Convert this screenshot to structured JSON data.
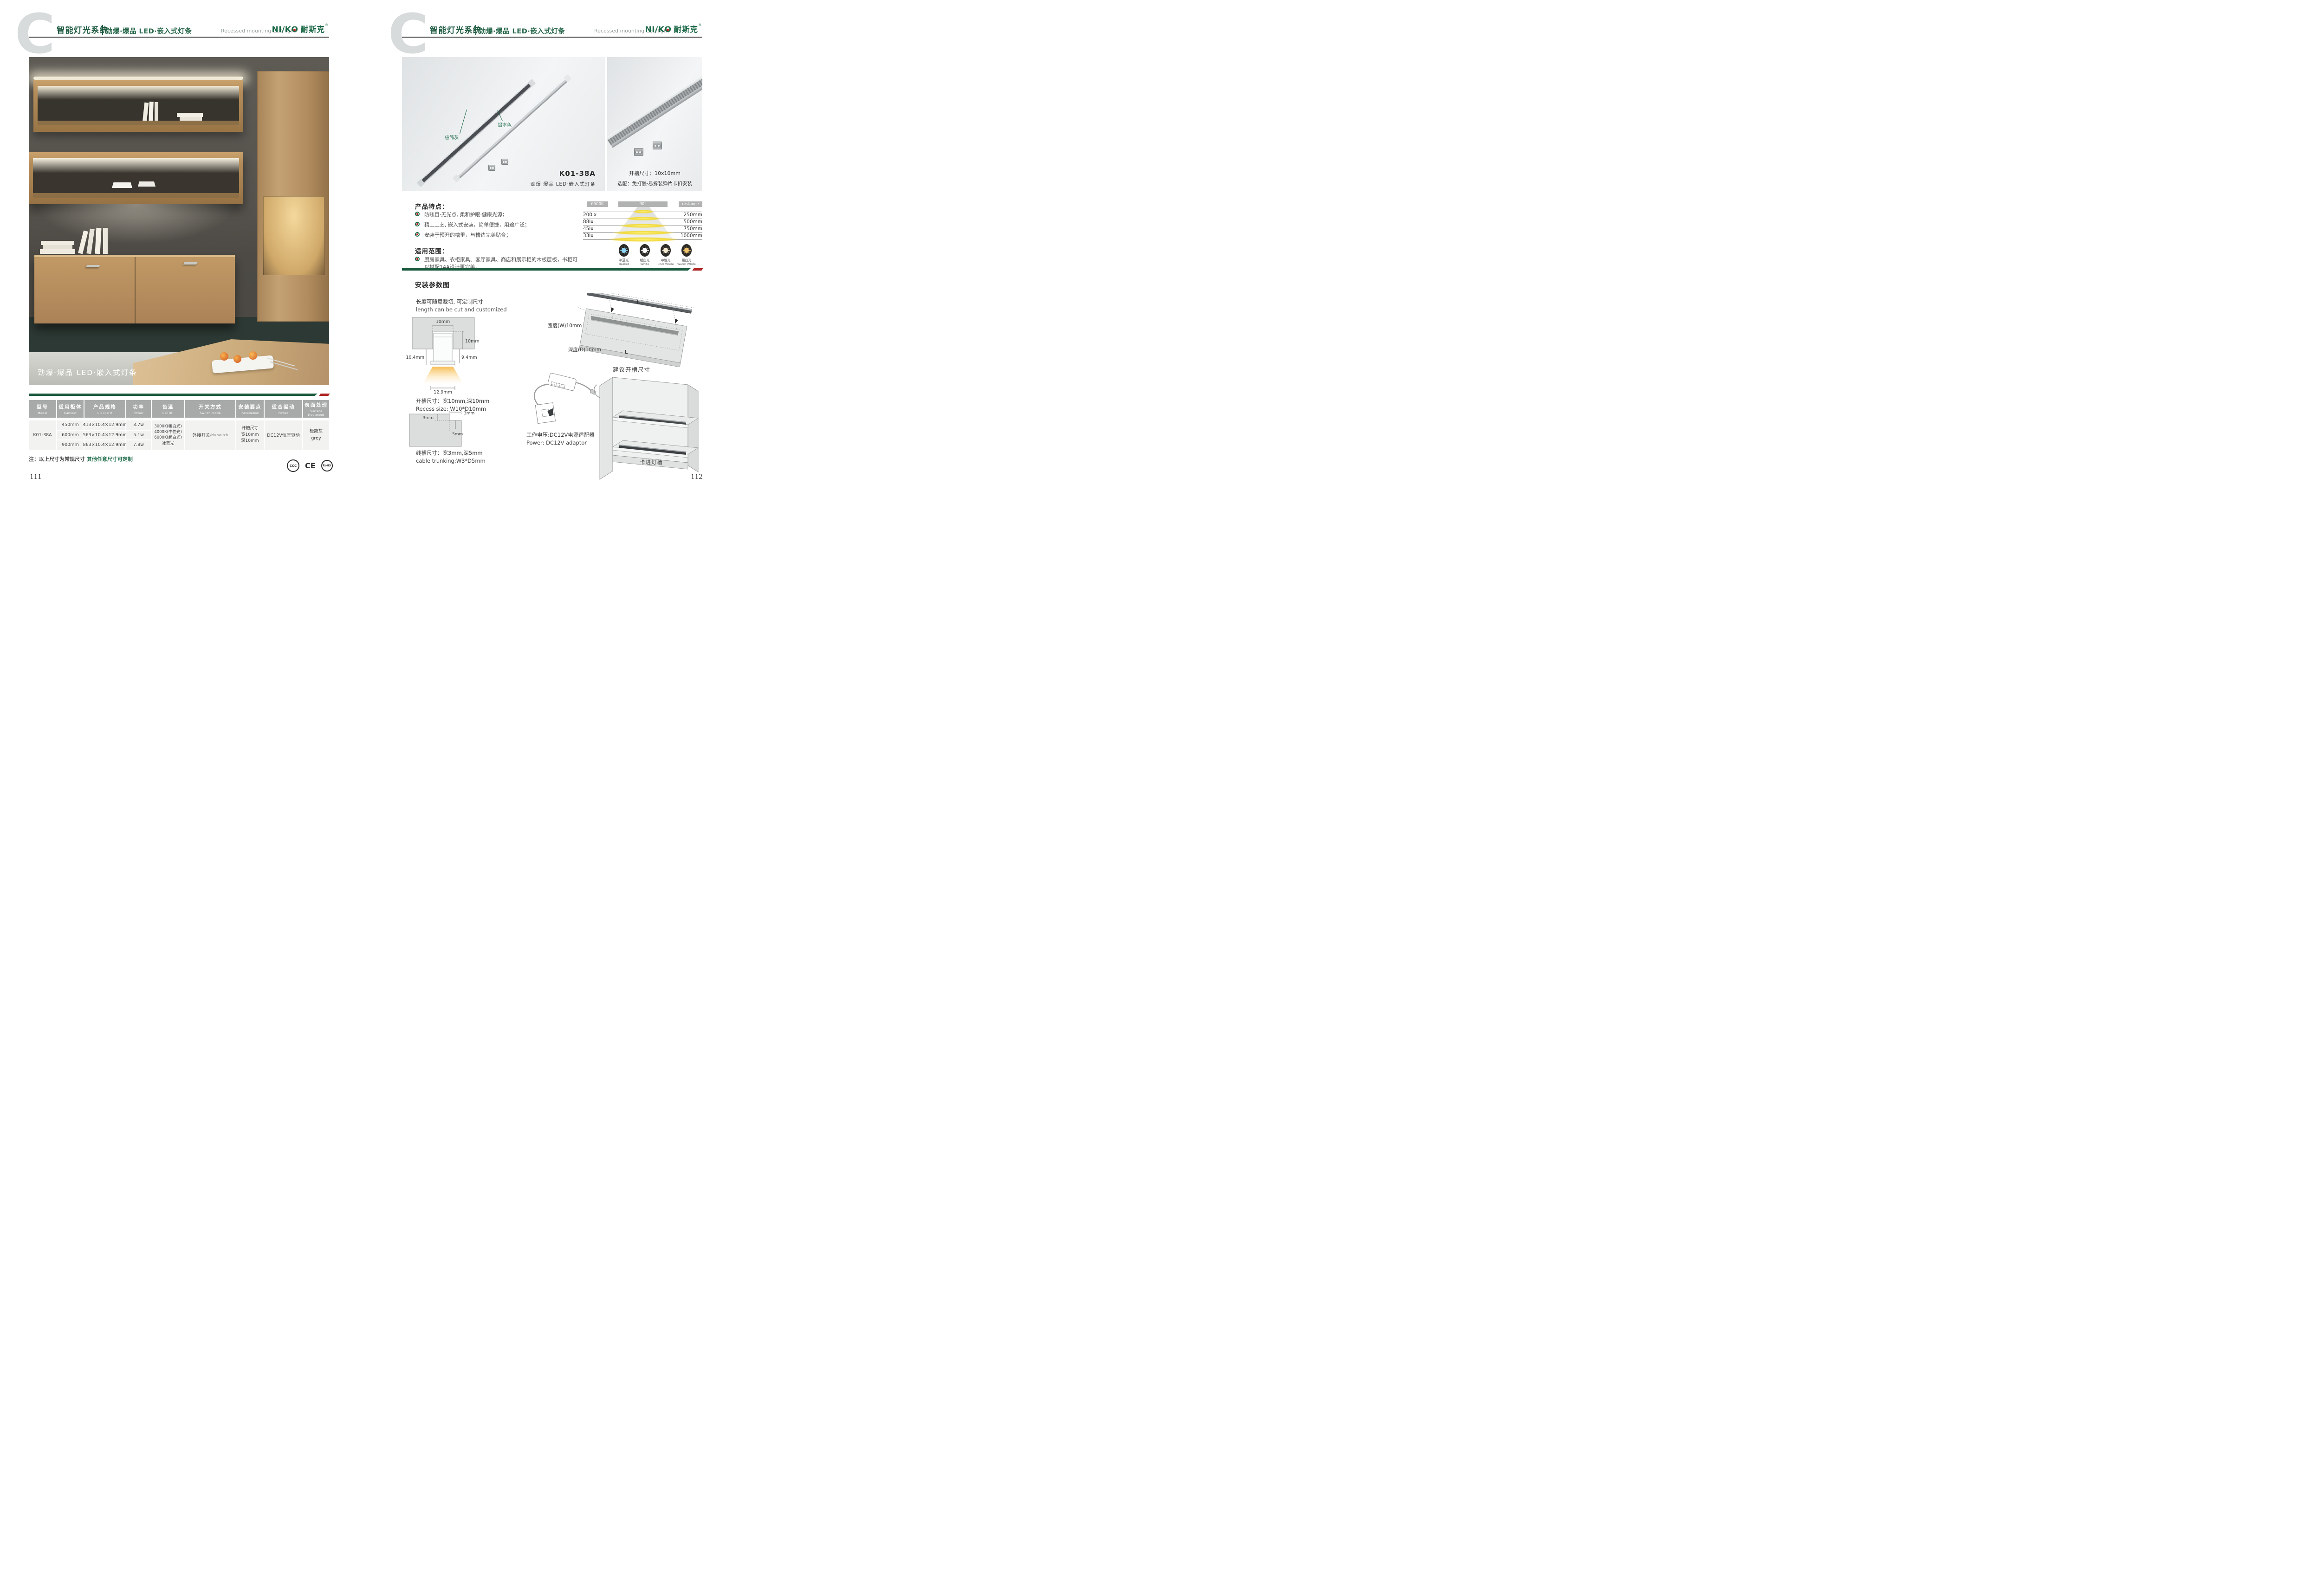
{
  "colors": {
    "brand_green": "#1f6b4a",
    "bar_green": "#1b5b40",
    "accent_red": "#ae2524",
    "header_gray": "#a7aaa9",
    "cell_gray": "#f2f2f1",
    "ice_blue": "#8fd4f5",
    "white": "#ffffff",
    "cool_white": "#f6ecd4",
    "warm_white": "#f2c56d"
  },
  "header": {
    "big_letter": "C",
    "title_cn": "智能灯光系统",
    "subtitle_cn": "劲爆·爆品  LED·嵌入式灯条",
    "subtitle_en": "Recessed mounting LED light",
    "logo": {
      "part1": "NI/K",
      "o": "O",
      "cn": "耐斯克",
      "reg": "®"
    }
  },
  "left_page": {
    "photo_caption": "劲爆·爆品  LED·嵌入式灯条",
    "table": {
      "headers": [
        {
          "cn": "型号",
          "en": "Model"
        },
        {
          "cn": "适用柜体",
          "en": "Cabinet"
        },
        {
          "cn": "产品规格",
          "en": "L x D x H"
        },
        {
          "cn": "功率",
          "en": "Power"
        },
        {
          "cn": "色温",
          "en": "CCT(K)"
        },
        {
          "cn": "开关方式",
          "en": "Switch mode"
        },
        {
          "cn": "安装要点",
          "en": "Installation"
        },
        {
          "cn": "适合驱动",
          "en": "Power"
        },
        {
          "cn": "表面处理",
          "en": "Surface treatment"
        }
      ],
      "model": "K01-38A",
      "rows": [
        {
          "cabinet": "450mm",
          "spec": "413×10.4×12.9mm",
          "power": "3.7w"
        },
        {
          "cabinet": "600mm",
          "spec": "563×10.4×12.9mm",
          "power": "5.1w"
        },
        {
          "cabinet": "900mm",
          "spec": "863×10.4×12.9mm",
          "power": "7.8w"
        }
      ],
      "cct_lines": [
        "3000K(暖白光)",
        "4000K(中性光)",
        "6000K(超白光)",
        "冰蓝光"
      ],
      "switch_main": "外接开关",
      "switch_sub": "/No switch",
      "install_lines": [
        "开槽尺寸",
        "宽10mm",
        "深10mm"
      ],
      "drive": "DC12V恒压驱动",
      "surface_lines": [
        "极简灰",
        "grey"
      ]
    },
    "note_prefix": "注：以上尺寸为常规尺寸 ",
    "note_highlight": "其他任意尺寸可定制",
    "certs": [
      {
        "label": "CCC"
      },
      {
        "label": "CE"
      },
      {
        "label": "RoHS"
      }
    ],
    "page_number": "111"
  },
  "right_page": {
    "photo_main": {
      "label_gray": "极简灰",
      "label_alu": "铝本色",
      "model": "K01-38A",
      "caption": "劲爆·爆品  LED·嵌入式灯条"
    },
    "photo_side": {
      "line1": "开槽尺寸：10x10mm",
      "line2": "选配：免打胶·易拆装弹片卡扣安装"
    },
    "features": {
      "title": "产品特点：",
      "items": [
        "防眩目·无光点, 柔和护眼·健康光源；",
        "精工工艺, 嵌入式安装，简单便捷，用途广泛；",
        "安装于预开的槽里，与槽边完美贴合；"
      ]
    },
    "scope": {
      "title": "适用范围：",
      "item": "厨房家具、衣柜家具、客厅家具、商店和展示柜的木板层板，书柜可以搭配14A设计更完美。"
    },
    "photometric": {
      "cct_chip": "6500K",
      "angle_chip": "90°",
      "distance_chip": "distance",
      "rows": [
        {
          "lux": "200lx",
          "distance": "250mm"
        },
        {
          "lux": "88lx",
          "distance": "500mm"
        },
        {
          "lux": "45lx",
          "distance": "750mm"
        },
        {
          "lux": "33lx",
          "distance": "1000mm"
        }
      ],
      "icons": [
        {
          "cn": "冰蓝光",
          "en": "Basket"
        },
        {
          "cn": "超白光",
          "en": "White"
        },
        {
          "cn": "中性光",
          "en": "Cool White"
        },
        {
          "cn": "暖白光",
          "en": "Warm White"
        }
      ]
    },
    "install": {
      "title": "安装参数图",
      "cut_cn": "长度可随意裁切, 可定制尺寸",
      "cut_en": "length can be cut and customized",
      "cs": {
        "top": "10mm",
        "right": "10mm",
        "inner": "9.9mm",
        "left": "10.4mm",
        "rightb": "9.4mm",
        "bottom": "12.9mm"
      },
      "recess_cn": "开槽尺寸：宽10mm,深10mm",
      "recess_en": "Recess size: W10*D10mm",
      "trunk": {
        "w_top": "3mm",
        "w_left": "3mm",
        "d": "5mm"
      },
      "trunk_cn": "线槽尺寸：宽3mm,深5mm",
      "trunk_en": "cable trunking:W3*D5mm",
      "board": {
        "len": "L",
        "len2": "L",
        "width": "宽度(W)10mm",
        "depth": "深度(D)10mm",
        "caption": "建议开槽尺寸"
      },
      "power_cn": "工作电压:DC12V电源适配器",
      "power_en": "Power: DC12V adaptor",
      "cabinet_label": "卡进灯槽"
    },
    "page_number": "112"
  }
}
